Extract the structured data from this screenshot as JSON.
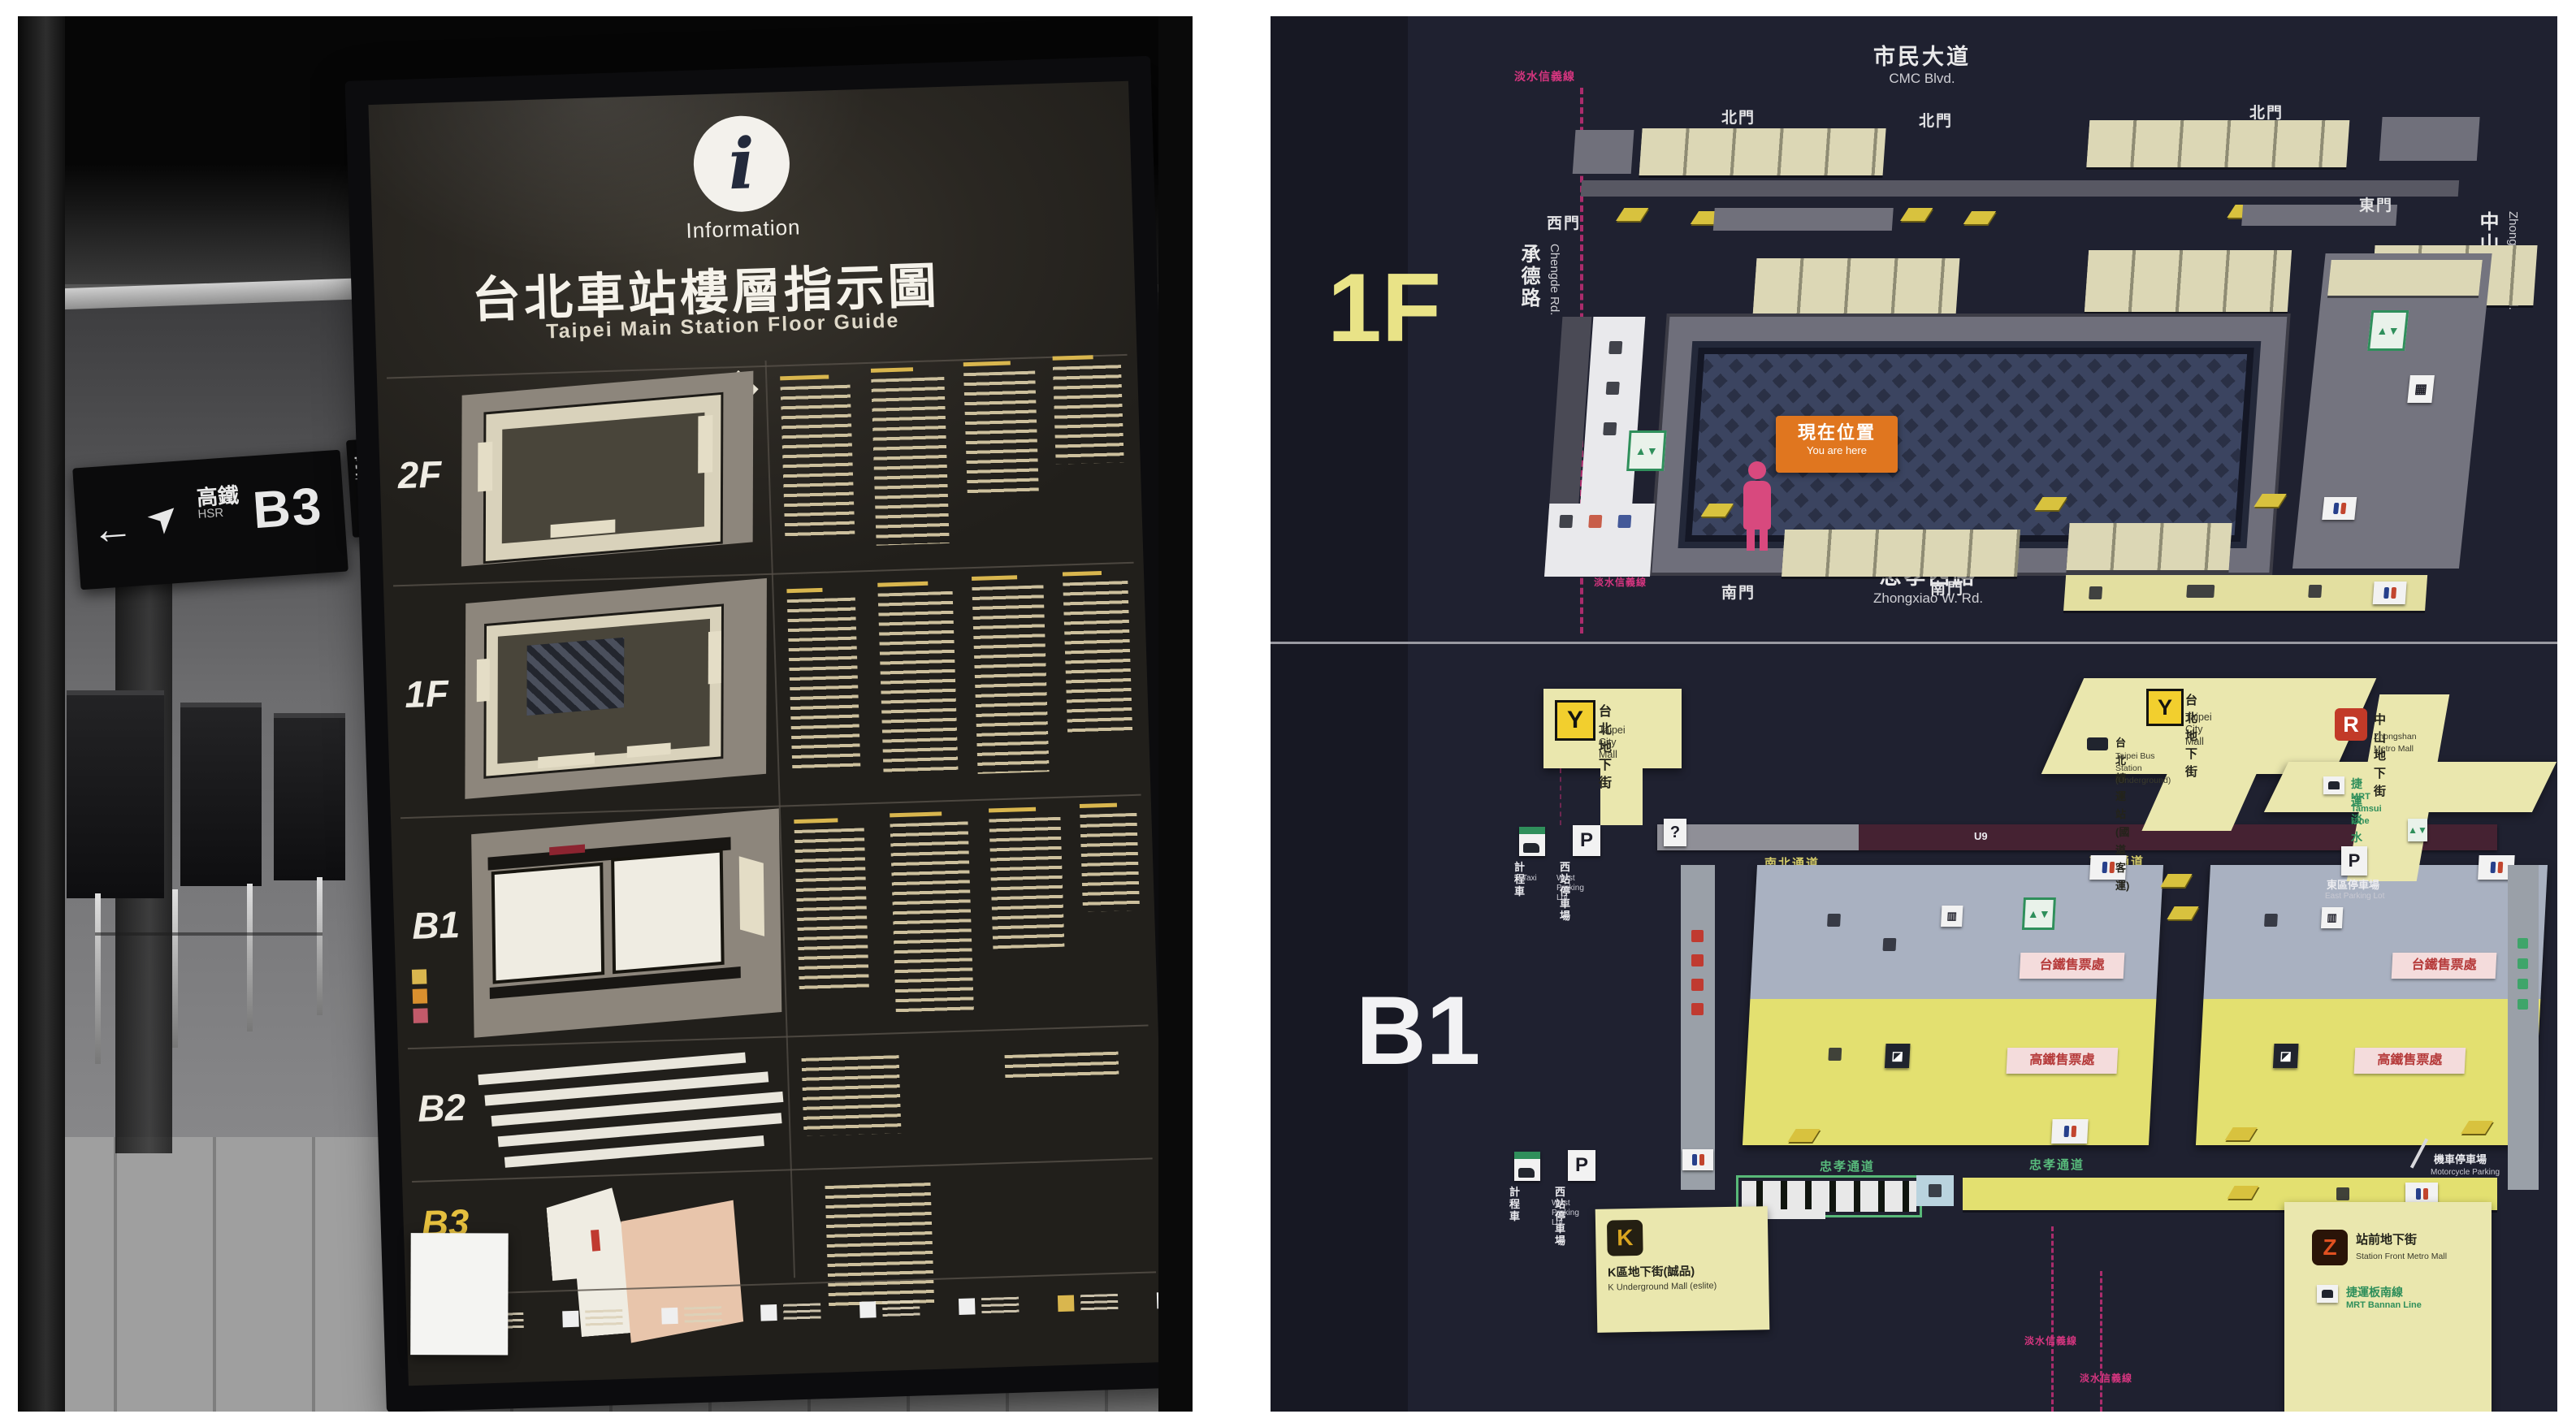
{
  "left_photo": {
    "ceiling_sign": {
      "arrow": "←",
      "mode_zh": "高鐵",
      "mode_en": "HSR",
      "floor": "B3"
    },
    "ceiling_sign_right": {
      "mode_zh": "臺鐵",
      "mode_en": "TRA"
    },
    "board": {
      "info_symbol": "i",
      "info_label": "Information",
      "title": "台北車站樓層指示圖",
      "subtitle": "Taipei Main Station Floor Guide",
      "floors": {
        "f2": "2F",
        "f1": "1F",
        "b1": "B1",
        "b2": "B2",
        "b3": "B3"
      }
    }
  },
  "right_photo": {
    "floor_1f": {
      "label": "1F",
      "road_top_zh": "市民大道",
      "road_top_en": "CMC Blvd.",
      "road_left_zh": "承德路",
      "road_left_en": "Chengde Rd.",
      "road_right_zh": "中山北路",
      "road_right_en": "Zhongshan N. Rd.",
      "road_bottom_zh": "忠孝西路",
      "road_bottom_en": "Zhongxiao W. Rd.",
      "gate_north": "北門",
      "gate_west": "西門",
      "gate_east": "東門",
      "gate_south": "南門",
      "you_are_here_zh": "現在位置",
      "you_are_here_en": "You are here",
      "mrt_line_label": "淡水信義線",
      "info_mark": "?"
    },
    "floor_b1": {
      "label": "B1",
      "callout_y_west": {
        "logo": "Y",
        "zh": "台北地下街",
        "en": "Taipei City Mall"
      },
      "callout_y_east": {
        "logo": "Y",
        "zh": "台北地下街",
        "en": "Taipei City Mall",
        "bus_zh": "台北轉運站(國道客運)",
        "bus_en": "Taipei Bus Station (Underground)"
      },
      "callout_r": {
        "logo": "R",
        "zh": "中山地下街",
        "en": "Zhongshan Metro Mall",
        "line_zh": "捷運淡水線",
        "line_en": "MRT Tamsui Line"
      },
      "callout_k": {
        "logo": "K",
        "zh": "K區地下街(誠品)",
        "en": "K Underground Mall (eslite)"
      },
      "callout_z": {
        "logo": "Z",
        "zh": "站前地下街",
        "en": "Station Front Metro Mall",
        "line_zh": "捷運板南線",
        "line_en": "MRT Bannan Line"
      },
      "area_tra": "台鐵售票處",
      "area_hsr": "高鐵售票處",
      "passage_north": "南北通道",
      "passage_south": "忠孝通道",
      "parking_mark": "P",
      "parking_west_zh": "西站停車場",
      "parking_west_en": "West Parking Lot",
      "parking_east_zh": "東區停車場",
      "parking_east_en": "East Parking Lot",
      "moto_zh": "機車停車場",
      "moto_en": "Motorcycle Parking",
      "taxi_zh": "計程車",
      "taxi_en": "Taxi",
      "exit_label": "U9",
      "info_mark": "?"
    }
  }
}
